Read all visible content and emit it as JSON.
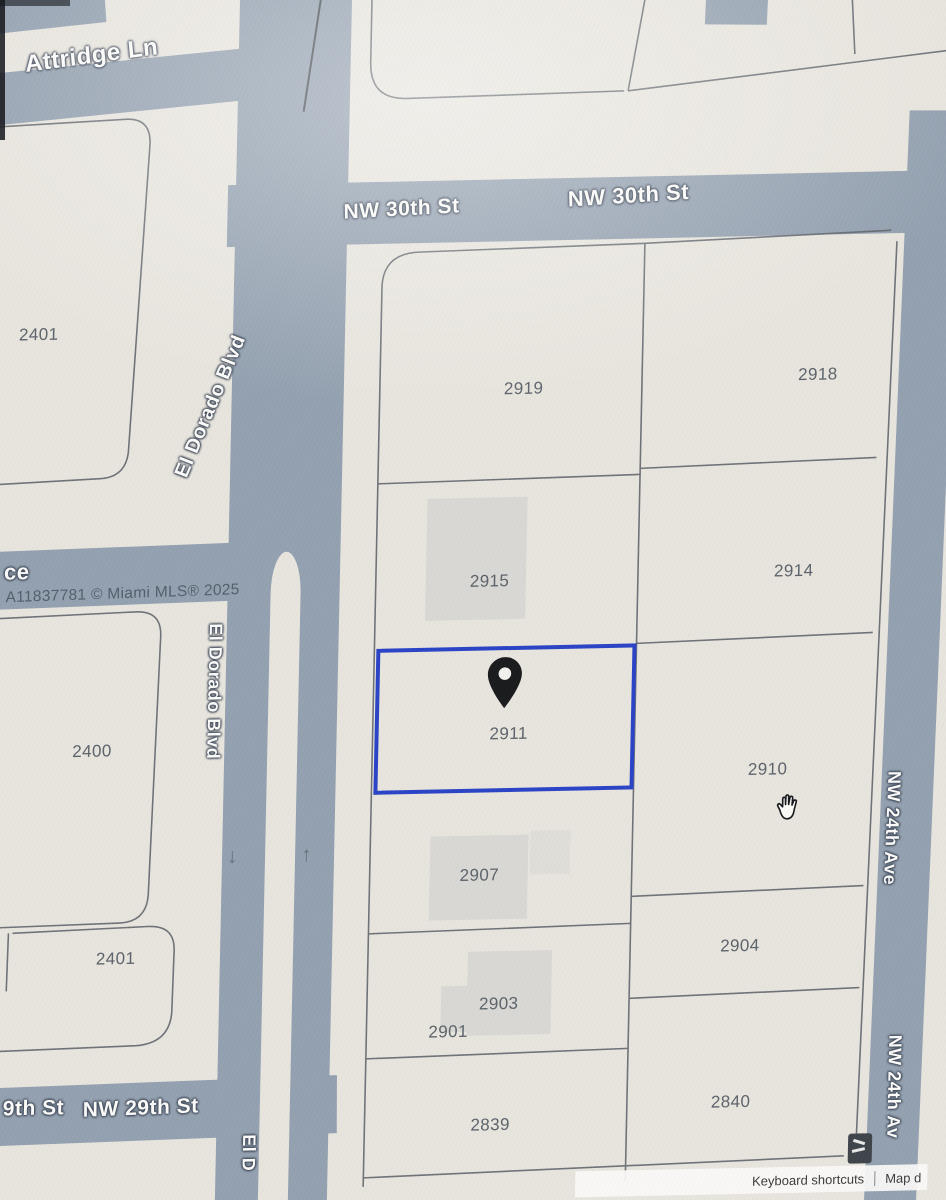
{
  "meta": {
    "selected_parcel": "2911",
    "watermark": "A11837781 © Miami MLS® 2025"
  },
  "streets": {
    "attridge": {
      "label": "Attridge Ln"
    },
    "nw30_a": {
      "label": "NW 30th St"
    },
    "nw30_b": {
      "label": "NW 30th St"
    },
    "eldorado_a": {
      "label": "El Dorado Blvd"
    },
    "eldorado_b": {
      "label": "El Dorado Blvd"
    },
    "eldorado_c": {
      "label": "El D"
    },
    "ce_partial": {
      "label": "ce"
    },
    "nw29_a": {
      "label": "9th St"
    },
    "nw29_b": {
      "label": "NW 29th St"
    },
    "nw24_a": {
      "label": "NW 24th Ave"
    },
    "nw24_b": {
      "label": "NW 24th Av"
    }
  },
  "parcels": [
    {
      "label": "2401"
    },
    {
      "label": "2400"
    },
    {
      "label": "2401"
    },
    {
      "label": "2919"
    },
    {
      "label": "2915"
    },
    {
      "label": "2911",
      "selected": true
    },
    {
      "label": "2907"
    },
    {
      "label": "2903"
    },
    {
      "label": "2901"
    },
    {
      "label": "2839"
    },
    {
      "label": "2918"
    },
    {
      "label": "2914"
    },
    {
      "label": "2910"
    },
    {
      "label": "2904"
    },
    {
      "label": "2840"
    }
  ],
  "icons": {
    "arrow_down": "↓",
    "arrow_up": "↑"
  },
  "footer": {
    "keyboard_shortcuts": "Keyboard shortcuts",
    "map_data_partial": "Map d"
  },
  "colors": {
    "background": "#e8e5de",
    "road": "#94a1b0",
    "selection": "#2b44c6",
    "parcel_line": "#5a6067",
    "parcel_label": "#5d646c",
    "building": "#d9d8d4",
    "watermark": "#4e5a66"
  }
}
